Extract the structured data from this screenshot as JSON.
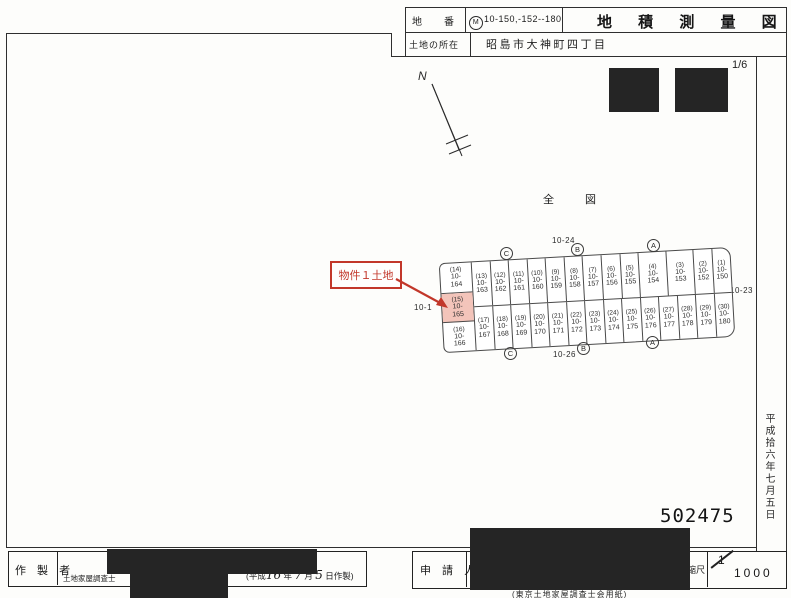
{
  "header": {
    "lot_number_label": "地　番",
    "lot_number_stamp": "M",
    "lot_number_value": "10-150,-152--180",
    "title": "地 積 測 量 図",
    "location_label": "土地の所在",
    "location_value": "昭島市大神町四丁目",
    "sheet_number": "1/6"
  },
  "map": {
    "north_label": "N",
    "overview_label": "全　図",
    "subject_annotation": "物件１土地",
    "road_labels": {
      "top": "10-24",
      "bottom": "10-26",
      "left": "10-1",
      "right": "10-23"
    },
    "point_markers_top": [
      "C",
      "B",
      "A"
    ],
    "point_markers_bottom": [
      "C",
      "B",
      "A"
    ],
    "highlight_color": "#f3c4ba",
    "annotation_color": "#c2372a",
    "parcels": {
      "left_column": [
        {
          "no": "(14)",
          "lot1": "10-",
          "lot2": "164"
        },
        {
          "no": "(15)",
          "lot1": "10-",
          "lot2": "165",
          "highlight": true
        },
        {
          "no": "(16)",
          "lot1": "10-",
          "lot2": "166"
        }
      ],
      "row1": [
        {
          "no": "(13)",
          "lot1": "10-",
          "lot2": "163"
        },
        {
          "no": "(12)",
          "lot1": "10-",
          "lot2": "162"
        },
        {
          "no": "(11)",
          "lot1": "10-",
          "lot2": "161"
        },
        {
          "no": "(10)",
          "lot1": "10-",
          "lot2": "160"
        },
        {
          "no": "(9)",
          "lot1": "10-",
          "lot2": "159"
        },
        {
          "no": "(8)",
          "lot1": "10-",
          "lot2": "158"
        },
        {
          "no": "(7)",
          "lot1": "10-",
          "lot2": "157"
        },
        {
          "no": "(6)",
          "lot1": "10-",
          "lot2": "156"
        },
        {
          "no": "(5)",
          "lot1": "10-",
          "lot2": "155"
        },
        {
          "no": "(4)",
          "lot1": "10-",
          "lot2": "154",
          "wide": true
        },
        {
          "no": "(3)",
          "lot1": "10-",
          "lot2": "153",
          "wide": true
        },
        {
          "no": "(2)",
          "lot1": "10-",
          "lot2": "152"
        },
        {
          "no": "(1)",
          "lot1": "10-",
          "lot2": "150"
        }
      ],
      "row2": [
        {
          "no": "(17)",
          "lot1": "10-",
          "lot2": "167"
        },
        {
          "no": "(18)",
          "lot1": "10-",
          "lot2": "168"
        },
        {
          "no": "(19)",
          "lot1": "10-",
          "lot2": "169"
        },
        {
          "no": "(20)",
          "lot1": "10-",
          "lot2": "170"
        },
        {
          "no": "(21)",
          "lot1": "10-",
          "lot2": "171"
        },
        {
          "no": "(22)",
          "lot1": "10-",
          "lot2": "172"
        },
        {
          "no": "(23)",
          "lot1": "10-",
          "lot2": "173"
        },
        {
          "no": "(24)",
          "lot1": "10-",
          "lot2": "174"
        },
        {
          "no": "(25)",
          "lot1": "10-",
          "lot2": "175"
        },
        {
          "no": "(26)",
          "lot1": "10-",
          "lot2": "176"
        },
        {
          "no": "(27)",
          "lot1": "10-",
          "lot2": "177"
        },
        {
          "no": "(28)",
          "lot1": "10-",
          "lot2": "178"
        },
        {
          "no": "(29)",
          "lot1": "10-",
          "lot2": "179"
        },
        {
          "no": "(30)",
          "lot1": "10-",
          "lot2": "180"
        }
      ]
    }
  },
  "stamps": {
    "document_number": "502475",
    "date_vertical": "平成拾六年七月五日"
  },
  "footer": {
    "creator_label": "作 製 者",
    "creator_title": "土地家屋調査士",
    "created_date": {
      "prefix": "(平成",
      "year": "16",
      "year_suffix": " 年 ",
      "month": "7",
      "month_suffix": " 月 ",
      "day": "5",
      "day_suffix": " 日作製)"
    },
    "applicant_label": "申 請 人",
    "scale_label": "縮尺",
    "scale_numerator": "1",
    "scale_denominator": "1000",
    "paper_note": "(東京土地家屋調査士会用紙)"
  }
}
